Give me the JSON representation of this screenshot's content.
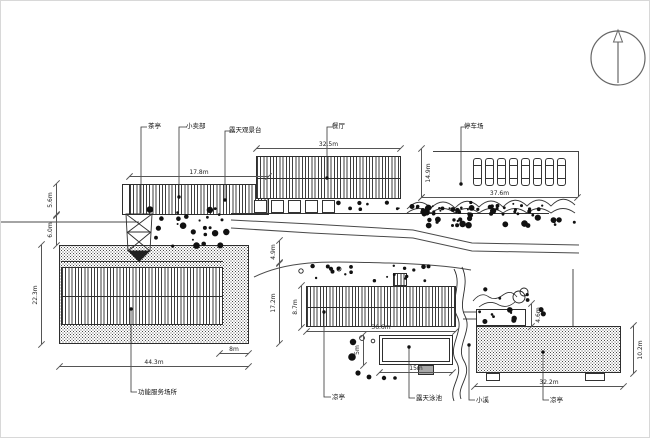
{
  "labels": {
    "teahouse": "茶亭",
    "shop": "小卖部",
    "viewing_deck": "露天观景台",
    "restaurant": "餐厅",
    "parking_lot": "停车场",
    "service_area": "功能服务场所",
    "pavilion_left": "凉亭",
    "pool": "露天泳池",
    "stream": "小溪",
    "pavilion_right": "凉亭"
  },
  "dims_h": [
    {
      "text": "17.8m"
    },
    {
      "text": "32.5m"
    },
    {
      "text": "37.6m"
    },
    {
      "text": "44.3m"
    },
    {
      "text": "8m"
    },
    {
      "text": "36.6m"
    },
    {
      "text": "15m"
    },
    {
      "text": "32.2m"
    }
  ],
  "dims_v": [
    {
      "text": "5.6m"
    },
    {
      "text": "6.0m"
    },
    {
      "text": "22.3m"
    },
    {
      "text": "14.9m"
    },
    {
      "text": "4.9m"
    },
    {
      "text": "17.2m"
    },
    {
      "text": "8.7m"
    },
    {
      "text": "5m"
    },
    {
      "text": "4.6m"
    },
    {
      "text": "10.2m"
    }
  ],
  "parking": {
    "car_count": 8
  },
  "icons": {
    "north_arrow": "north-arrow-icon",
    "car": "car-icon",
    "shrub": "shrub-icon"
  },
  "colors": {
    "line": "#3f3f3f",
    "ink": "#111111",
    "background": "#ffffff"
  }
}
